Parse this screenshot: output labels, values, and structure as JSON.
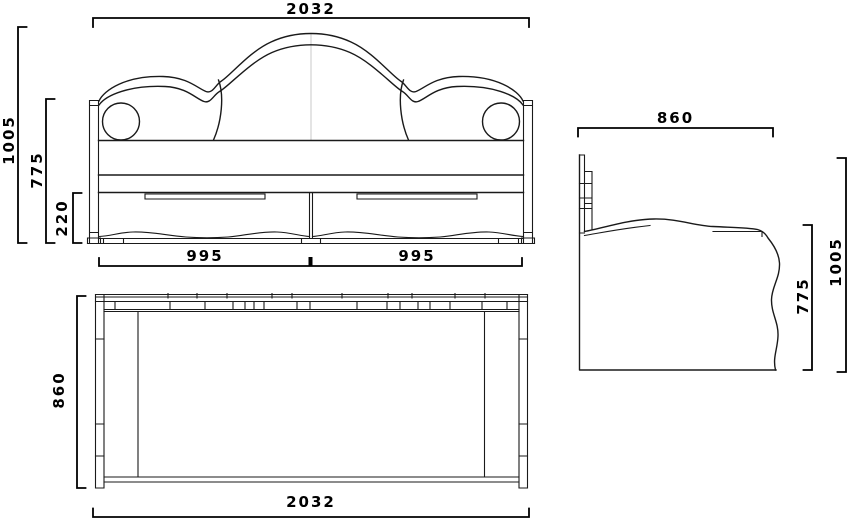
{
  "drawing": {
    "background": "#ffffff",
    "line_color": "#1a1a1a",
    "dim_color": "#000000",
    "centerline_color": "#c8c8c8",
    "front_view": {
      "dim_overall_width": "2032",
      "dim_overall_height": "1005",
      "dim_back_height": "775",
      "dim_drawer_height": "220",
      "dim_drawer_left": "995",
      "dim_drawer_right": "995"
    },
    "plan_view": {
      "dim_depth": "860",
      "dim_overall_width": "2032"
    },
    "side_view": {
      "dim_depth": "860",
      "dim_overall_height": "1005",
      "dim_back_height": "775"
    }
  }
}
